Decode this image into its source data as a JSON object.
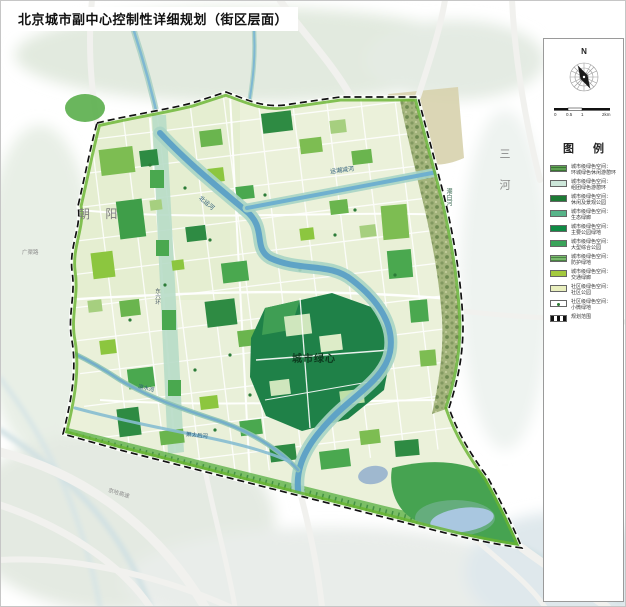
{
  "page": {
    "title": "北京城市副中心控制性详细规划（街区层面）"
  },
  "panel": {
    "north_label": "N",
    "scale_ticks": [
      "0",
      "0.5",
      "1",
      "2km"
    ],
    "legend_title": "图 例",
    "legend": [
      {
        "line1": "城市级绿色空间：",
        "line2": "环城绿色休闲游憩环",
        "color": "#5fa054",
        "style": "hatch-green"
      },
      {
        "line1": "城市级绿色空间：",
        "line2": "组团绿色游憩环",
        "color": "#cde7da",
        "style": "solid"
      },
      {
        "line1": "城市级绿色空间：",
        "line2": "休闲及景观公园",
        "color": "#1d7a35",
        "style": "solid"
      },
      {
        "line1": "城市级绿色空间：",
        "line2": "生态绿廊",
        "color": "#57b489",
        "style": "solid"
      },
      {
        "line1": "城市级绿色空间：",
        "line2": "主要公园绿地",
        "color": "#0f8a44",
        "style": "solid"
      },
      {
        "line1": "城市级绿色空间：",
        "line2": "大型综合公园",
        "color": "#3aa35a",
        "style": "solid"
      },
      {
        "line1": "城市级绿色空间：",
        "line2": "防护绿地",
        "color": "#7ab96e",
        "style": "hatch-green"
      },
      {
        "line1": "城市级绿色空间：",
        "line2": "交通绿廊",
        "color": "#a3c93e",
        "style": "solid"
      },
      {
        "line1": "社区级绿色空间：",
        "line2": "社区公园",
        "color": "#e9efbe",
        "style": "solid"
      },
      {
        "line1": "社区级绿色空间：",
        "line2": "小微绿地",
        "color": "#ffffff",
        "style": "dot"
      },
      {
        "line1": "规划范围",
        "line2": "",
        "color": "#ffffff",
        "style": "boundary"
      }
    ]
  },
  "map": {
    "labels": {
      "chaoyang": "朝 阳",
      "sanhe": "三 河",
      "green_heart": "城市绿心",
      "beiyunhe_river": "北运河",
      "yunchaojian_river": "运潮减河",
      "chaobai_river": "潮白河",
      "liangshui_river": "凉水河",
      "xiaotaihou_river": "萧太后河",
      "jingha_expressway": "京哈高速",
      "guangqu_road": "广渠路",
      "dongliuhuan_road": "东六环"
    },
    "colors": {
      "interior": "#ebf1da",
      "green_ring": "#68b42f",
      "green_dark": "#1f8148",
      "green_mid": "#4aa84f",
      "green_bright": "#7dbd52",
      "water": "#5fa3c6",
      "water_bank": "#a7d4c4",
      "boundary": "#111111",
      "riparian": "#a3b47c",
      "farmland": "#d7d2ad",
      "lake": "#a9c7e0",
      "wash": "#e2eadf"
    }
  }
}
